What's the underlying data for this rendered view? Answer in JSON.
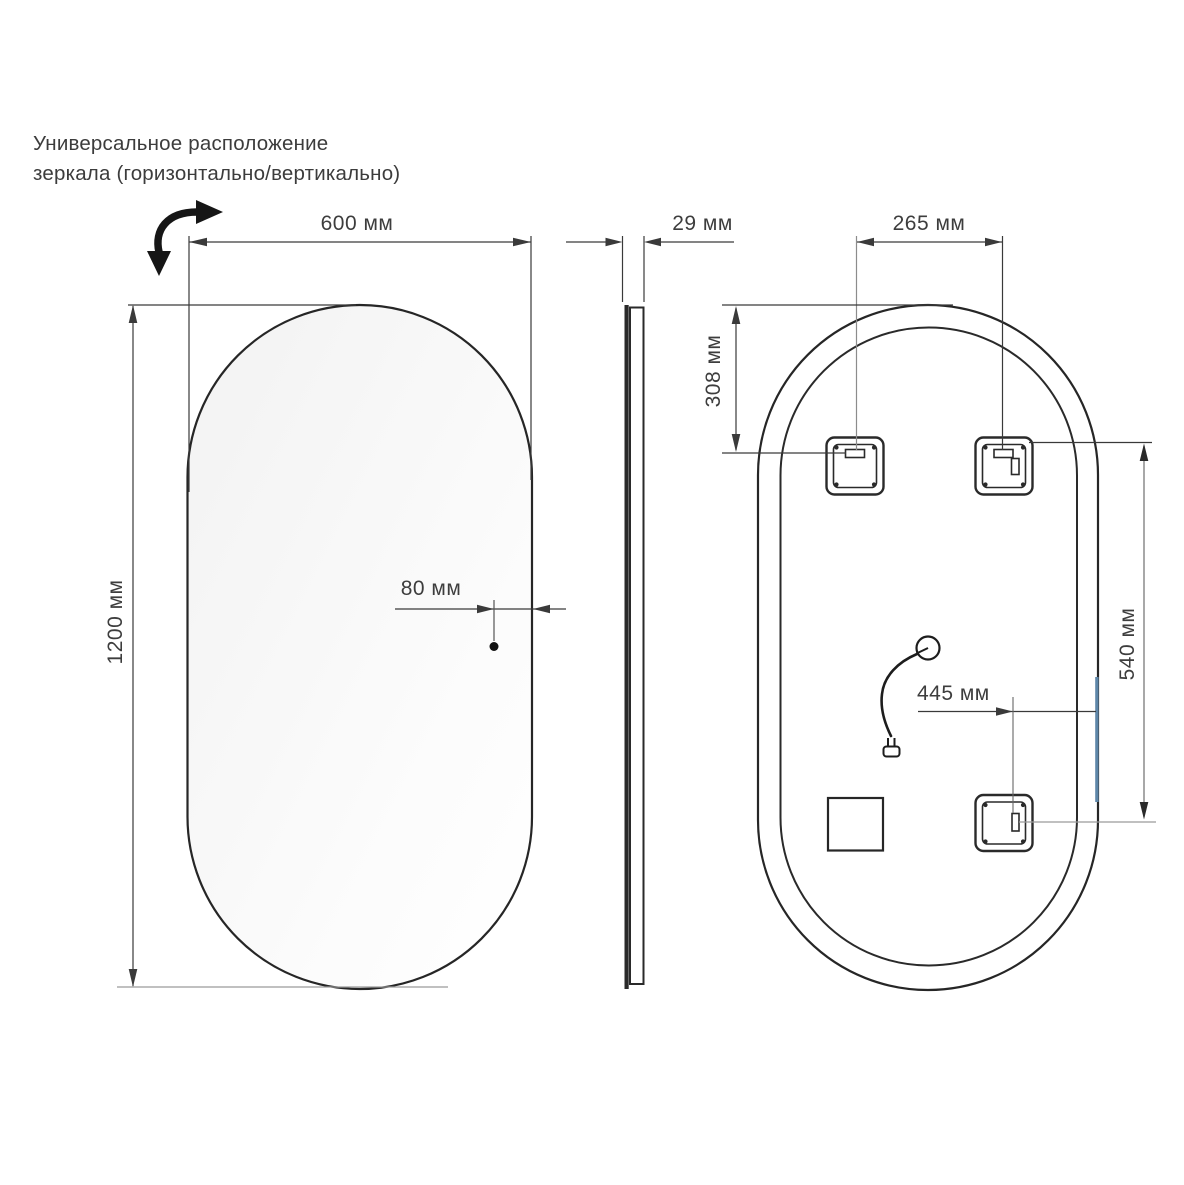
{
  "annotation": {
    "line1": "Универсальное расположение",
    "line2": "зеркала (горизонтально/вертикально)"
  },
  "dimensions": {
    "front_width": "600 мм",
    "front_height": "1200 мм",
    "sensor_offset": "80 мм",
    "side_thickness": "29 мм",
    "bracket_spacing": "265 мм",
    "bracket_top_offset": "308 мм",
    "cable_offset": "445 мм",
    "bracket_vertical_span": "540 мм"
  },
  "colors": {
    "outline": "#262626",
    "dimension_line": "#3a3a3a",
    "text": "#3d3d3d",
    "led_highlight": "#5e86a8",
    "background": "#ffffff"
  }
}
